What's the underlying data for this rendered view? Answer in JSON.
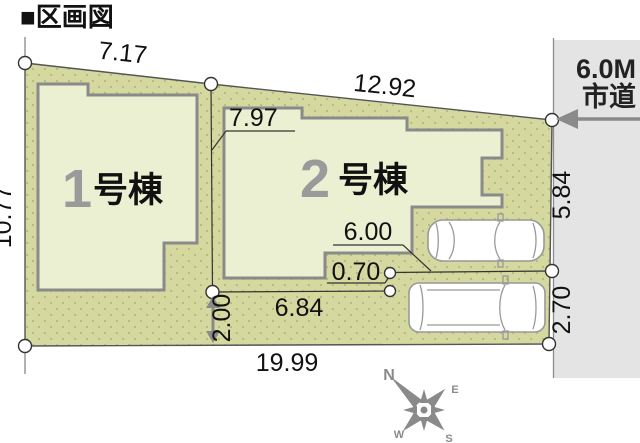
{
  "title": "■区画図",
  "road": {
    "width_label": "6.0M",
    "name_label": "市道"
  },
  "buildings": [
    {
      "no": "1",
      "suffix": "号棟"
    },
    {
      "no": "2",
      "suffix": "号棟"
    }
  ],
  "dimensions": {
    "top_left": "7.17",
    "top_right": "12.92",
    "building2_frontage": "7.97",
    "left_side": "10.77",
    "right_upper": "5.84",
    "right_lower": "2.70",
    "parking_length": "6.00",
    "offset": "0.70",
    "parking_frontage": "6.84",
    "bottom": "19.99",
    "setback": "2.00"
  },
  "compass": {
    "north": "N",
    "east": "E",
    "south": "S",
    "west": "W"
  },
  "colors": {
    "lot_fill": "#d5d89f",
    "lot_dot": "#b5b97e",
    "building_fill": "#ecf0d3",
    "building_border": "#8a8a8a",
    "road_fill": "#e4e4e4",
    "accent_gray": "#8a8a8a",
    "text_black": "#111111",
    "number_gray": "#9a9a9a"
  }
}
